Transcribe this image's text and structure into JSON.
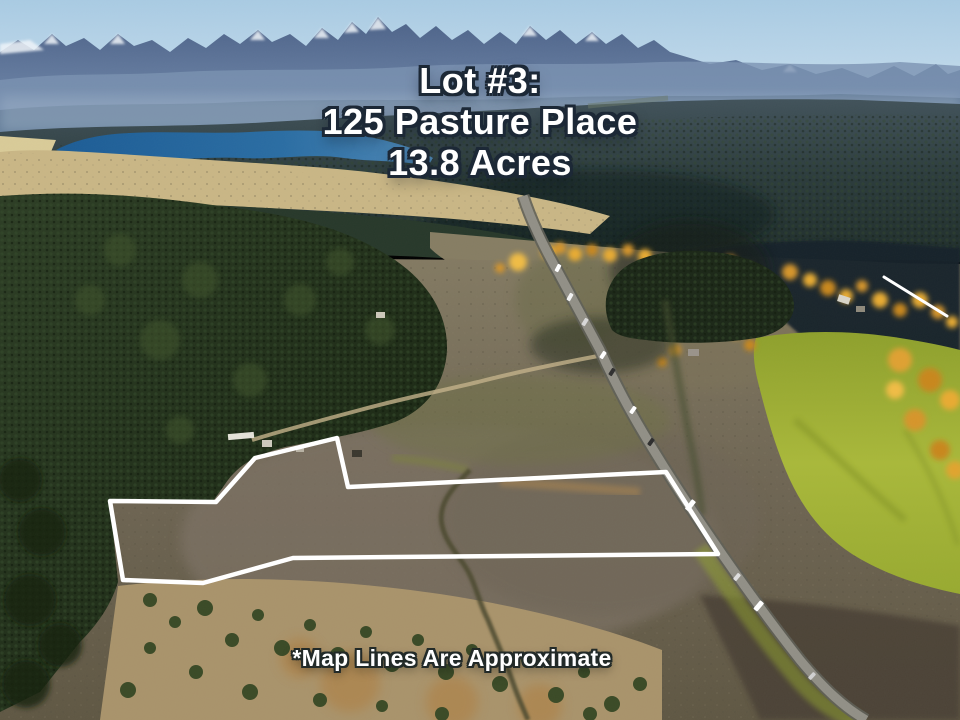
{
  "overlay": {
    "title_lines": [
      "Lot #3:",
      "125 Pasture Place",
      "13.8 Acres"
    ],
    "disclaimer": "*Map Lines Are Approximate",
    "text_color": "#ffffff",
    "text_outline_color": "#1c2836"
  },
  "boundary": {
    "points": "337,438 348,487 666,472 718,554 293,558 203,583 123,580 110,501 216,502 255,458",
    "color": "#ffffff",
    "width": "4.5"
  },
  "contrail": {
    "x1": "884",
    "y1": "277",
    "x2": "947",
    "y2": "316",
    "color": "#ffffff"
  },
  "photo": {
    "colors": {
      "sky": "#bdd7ea",
      "mountains": "#5b749c",
      "lake": "#2a6da3",
      "forest_dark": "#22301d",
      "valley_brown": "#6e6553",
      "pasture_green": "#a2b135",
      "autumn_gold": "#e0a42f",
      "highway_gray": "#8f8d85"
    }
  }
}
